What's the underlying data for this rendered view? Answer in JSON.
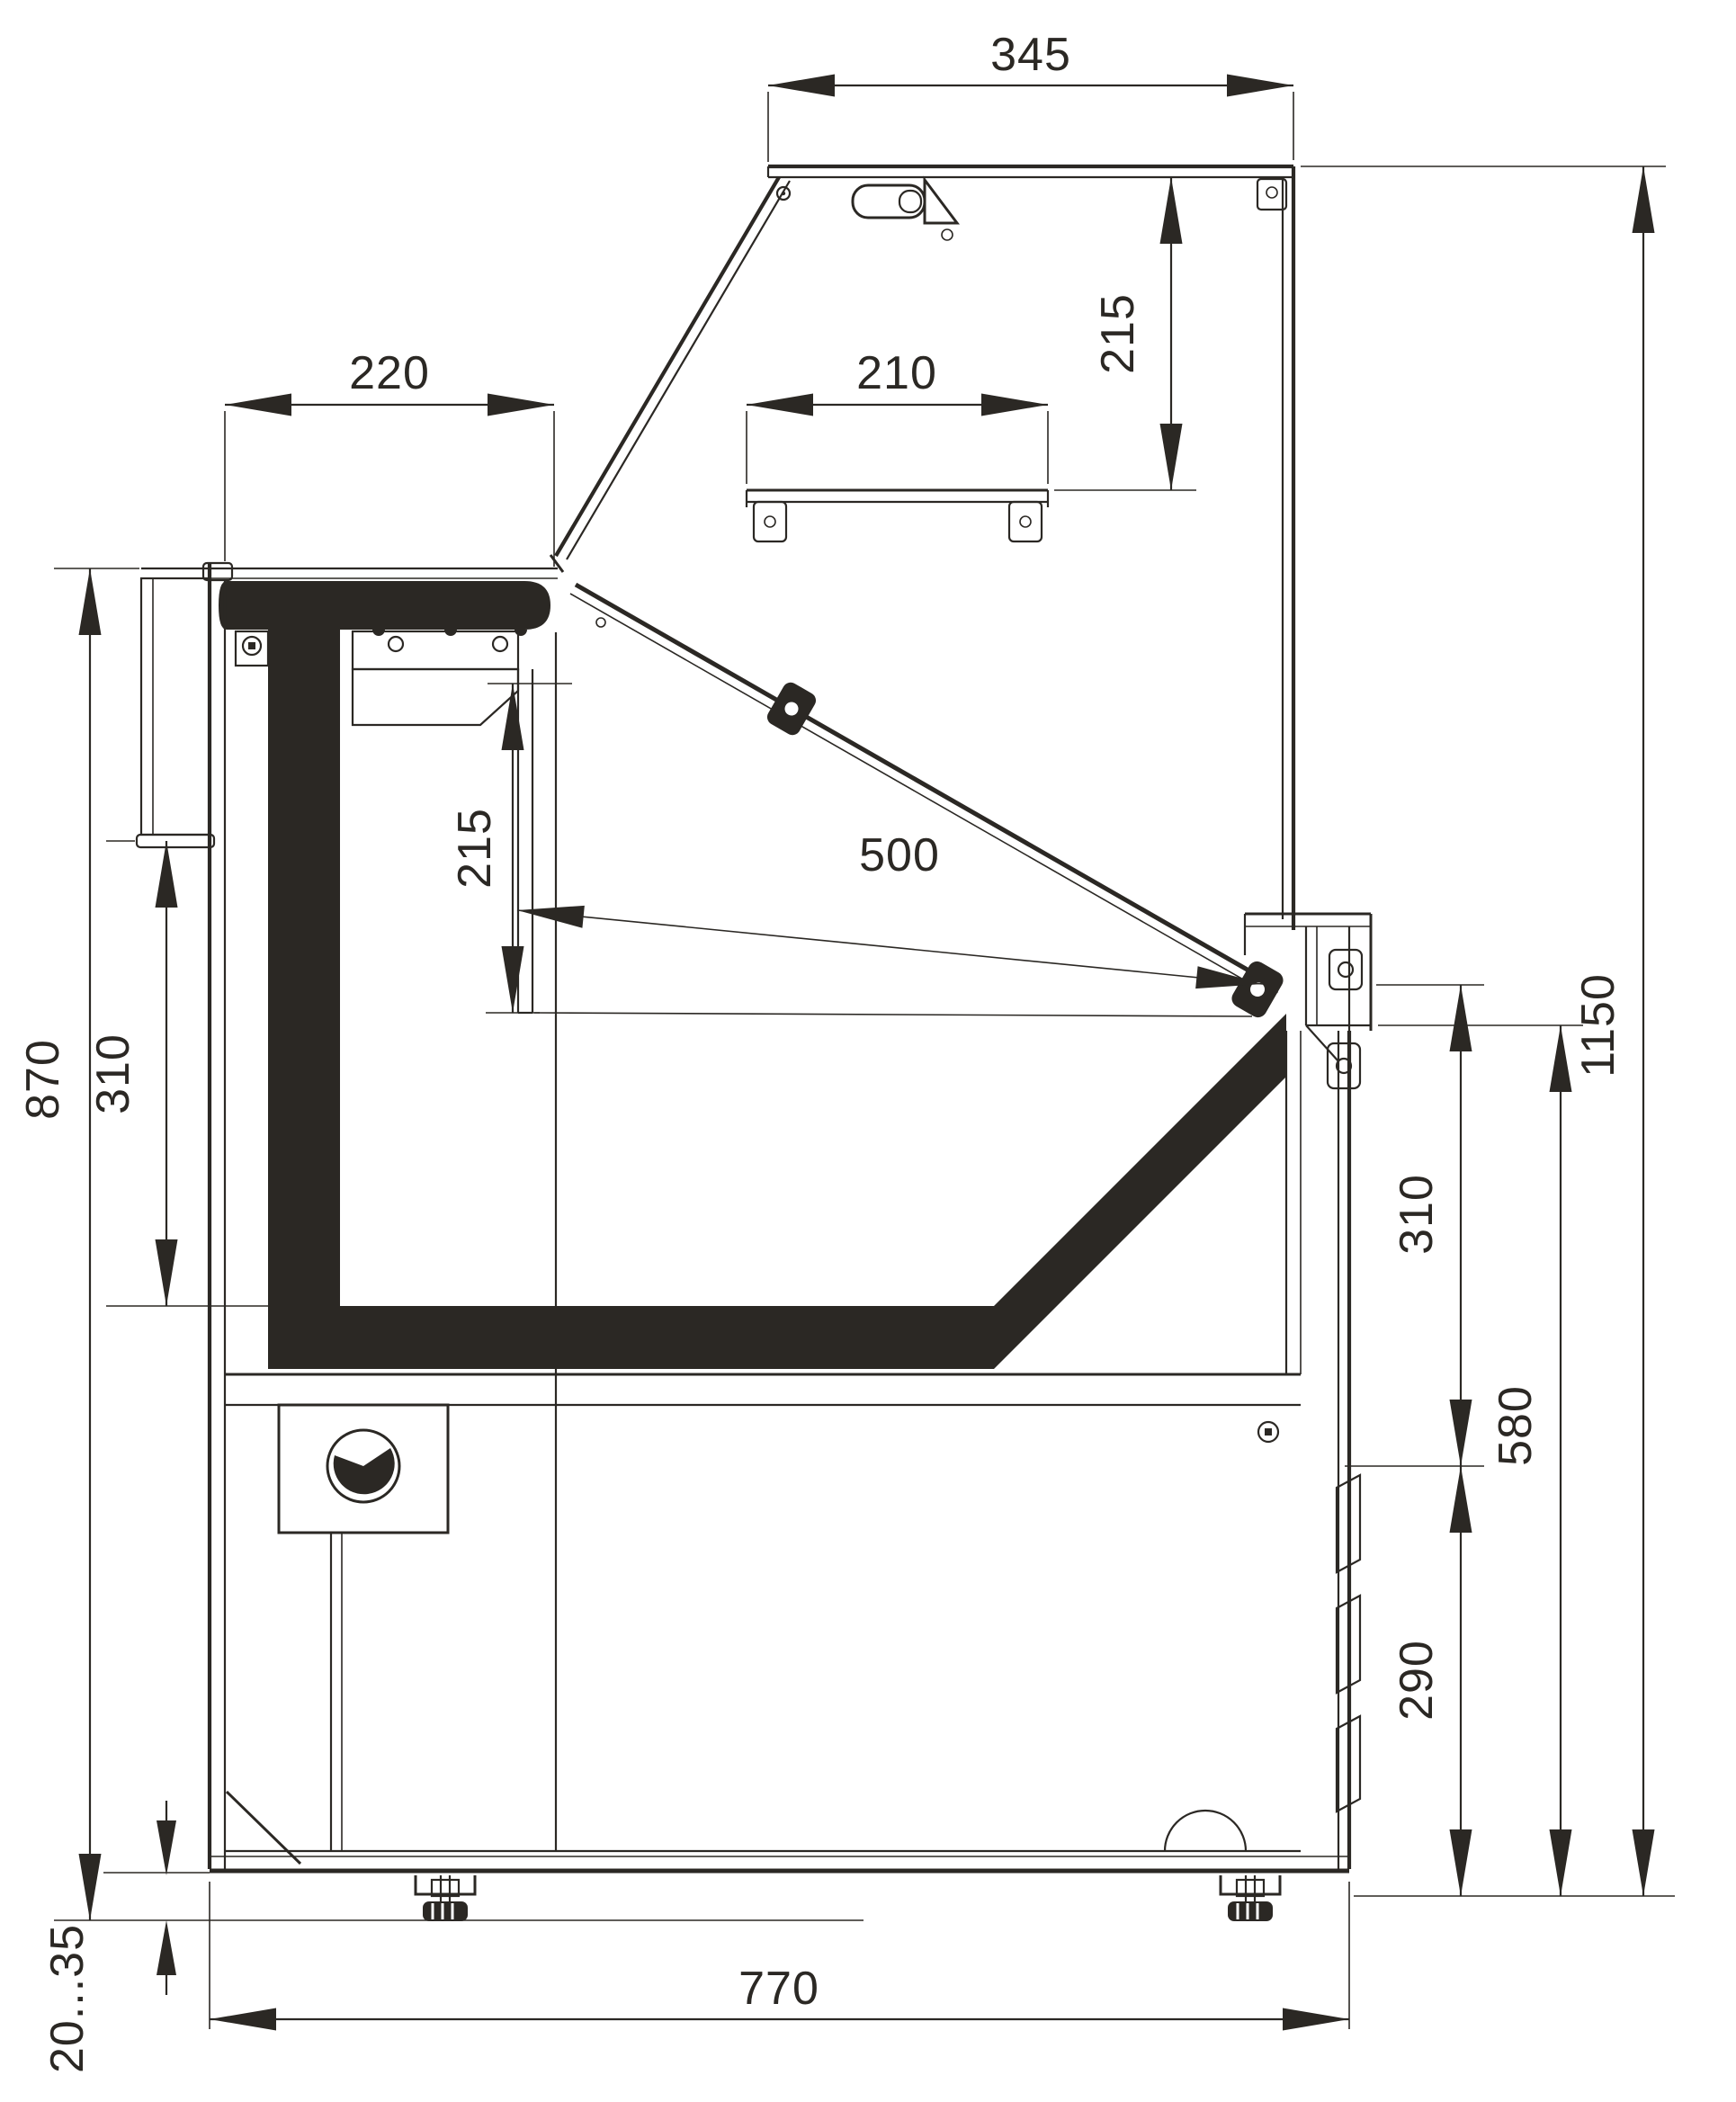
{
  "drawing": {
    "type": "technical-cross-section",
    "subject": "refrigerated serve-over display counter, side section with dimensions",
    "units": "mm",
    "ink_color": "#2b2824",
    "background_color": "#ffffff",
    "dims": {
      "canopy_depth": "345",
      "canopy_to_shelf": "215",
      "worktop_depth": "220",
      "shelf_depth": "210",
      "display_opening_width": "500",
      "left_opening_height": "310",
      "worktop_height": "870",
      "mid_opening_height": "215",
      "overall_height": "1150",
      "front_upper_height": "310",
      "front_height": "580",
      "louver_zone_height": "290",
      "feet_adjust_range": "20...35",
      "body_depth": "770"
    }
  }
}
